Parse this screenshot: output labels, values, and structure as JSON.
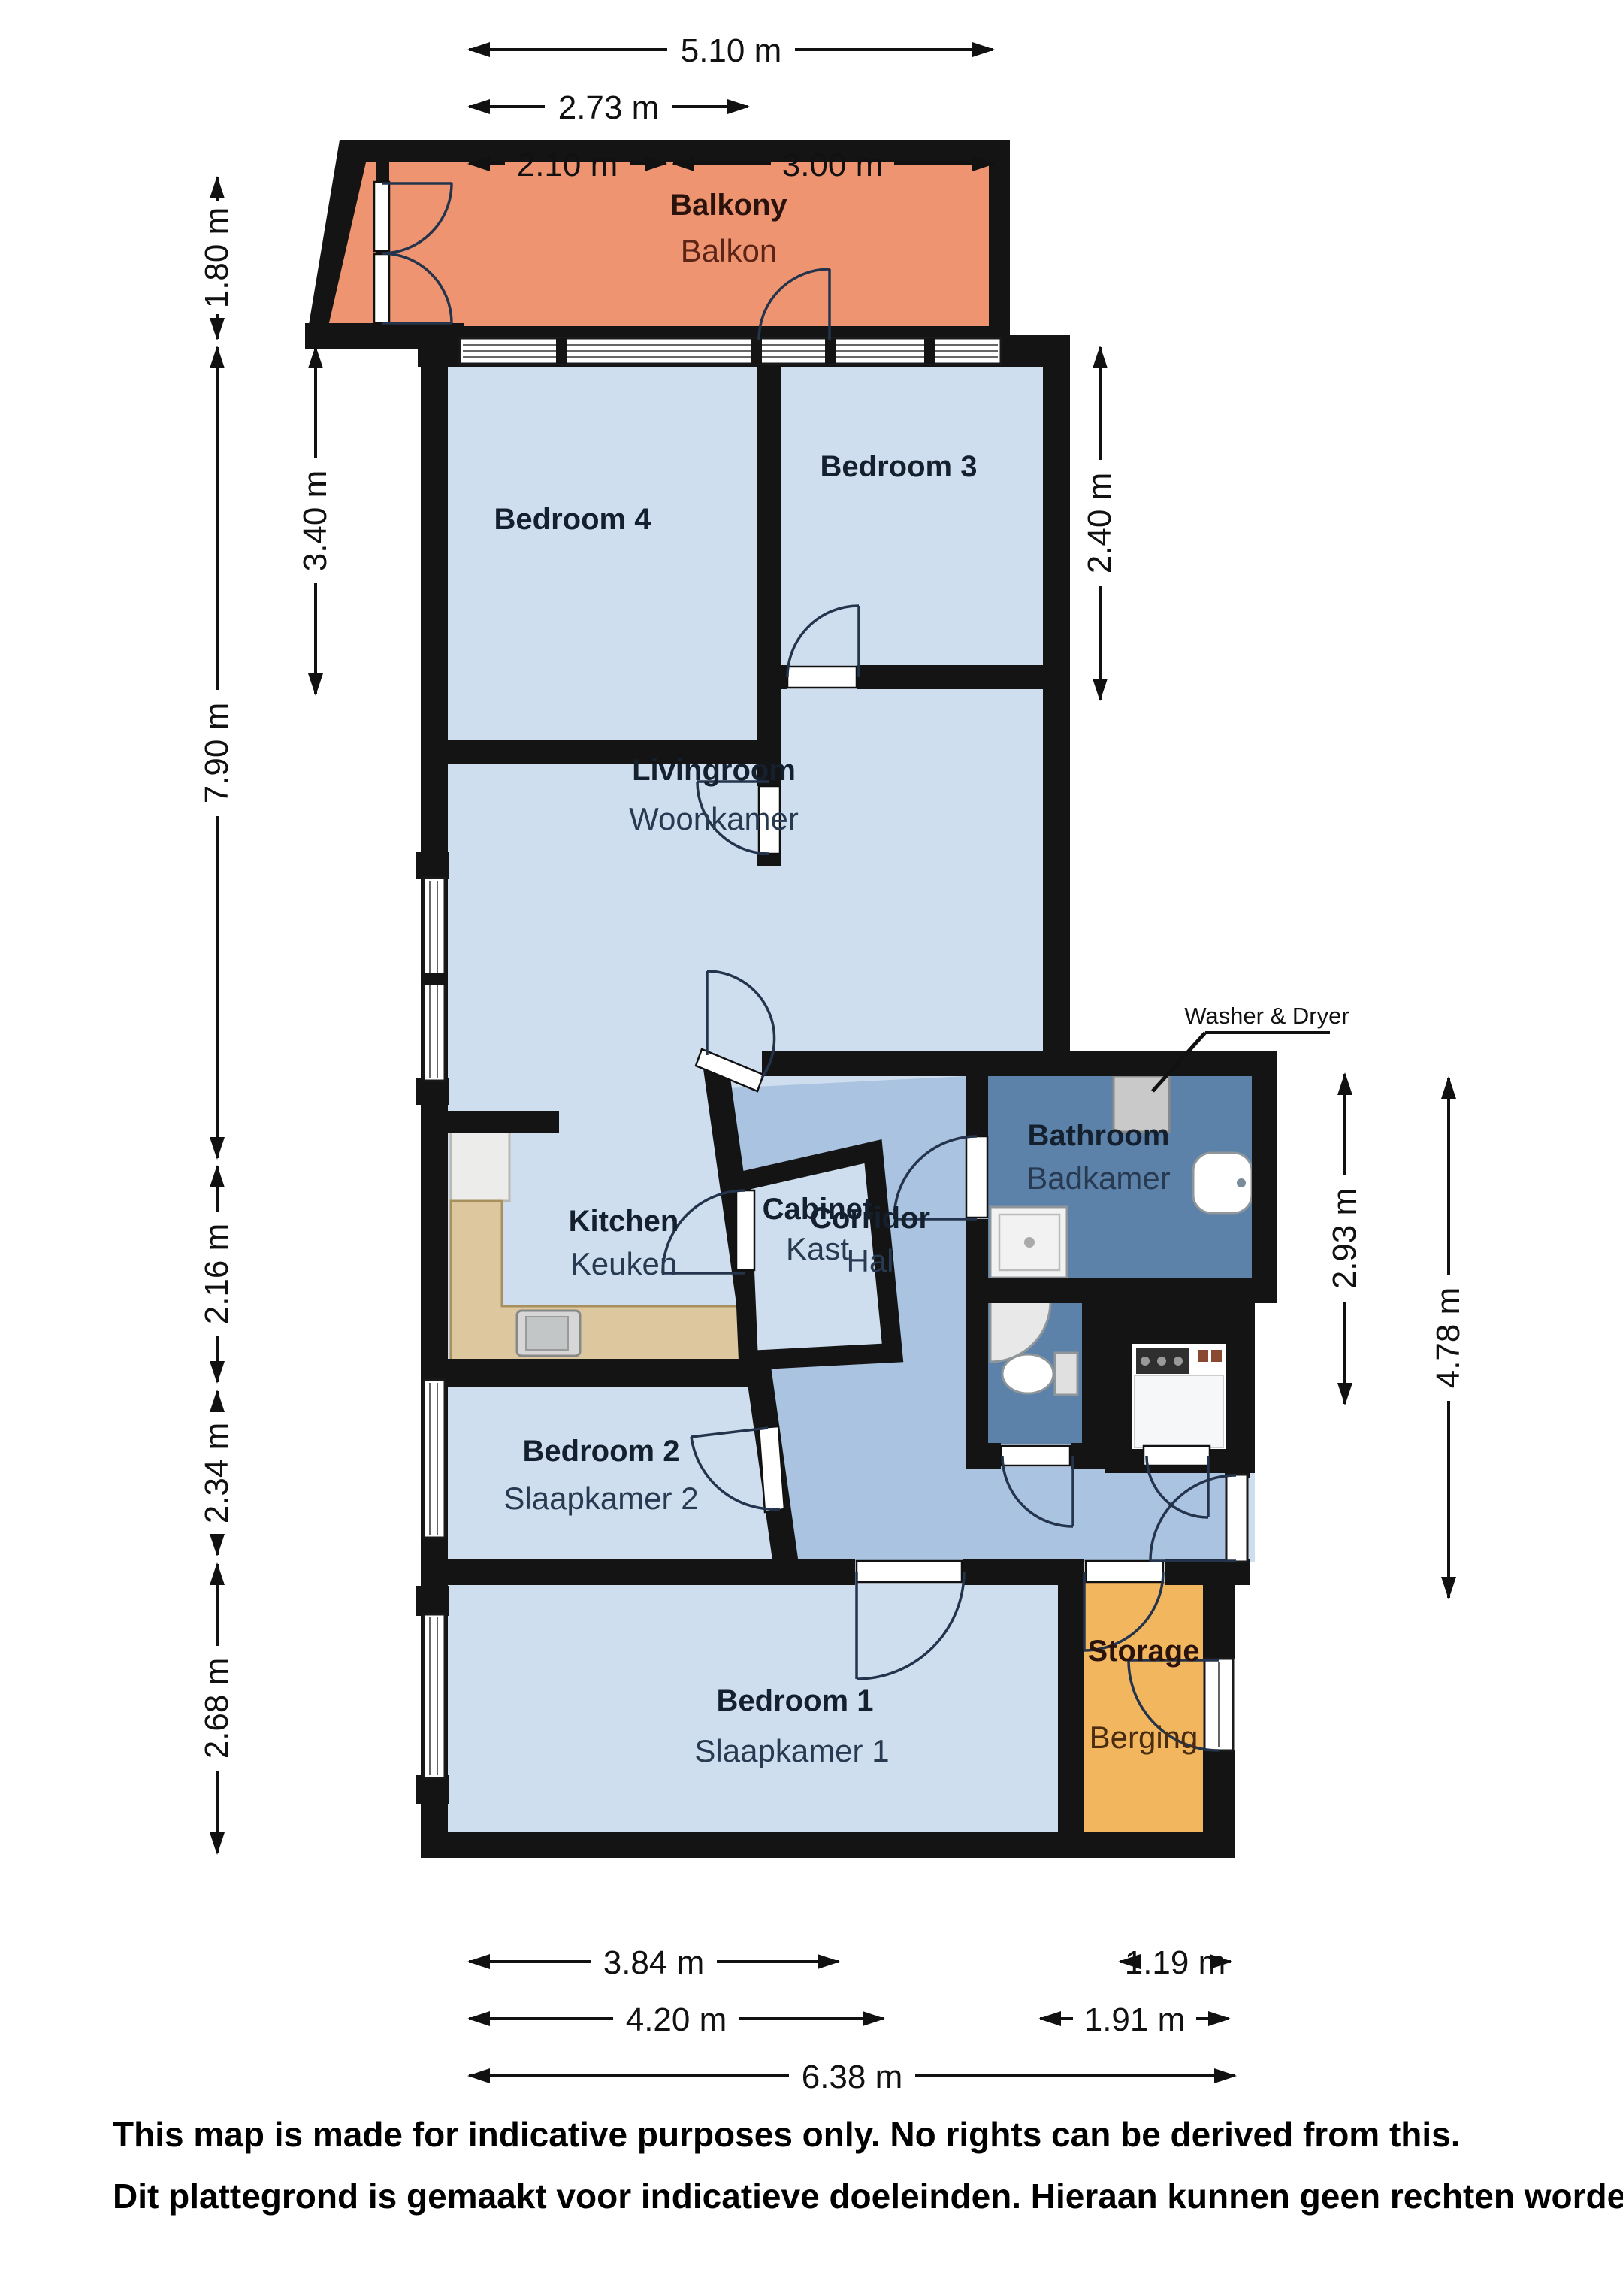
{
  "rooms": [
    {
      "en": "Balkony",
      "du": "Balkon"
    },
    {
      "en": "Bedroom 3",
      "du": ""
    },
    {
      "en": "Bedroom 4",
      "du": ""
    },
    {
      "en": "Livingroom",
      "du": "Woonkamer"
    },
    {
      "en": "Kitchen",
      "du": "Keuken"
    },
    {
      "en": "Cabinet",
      "du": "Kast"
    },
    {
      "en": "Corridor",
      "du": "Hal"
    },
    {
      "en": "Bathroom",
      "du": "Badkamer"
    },
    {
      "en": "Bedroom 2",
      "du": "Slaapkamer 2"
    },
    {
      "en": "Bedroom 1",
      "du": "Slaapkamer 1"
    },
    {
      "en": "Storage",
      "du": "Berging"
    }
  ],
  "annotations": {
    "washer_dryer": "Washer & Dryer"
  },
  "dimensions": {
    "top": [
      "5.10 m",
      "2.73 m",
      "2.10 m",
      "3.00 m"
    ],
    "left": [
      "1.80 m",
      "3.40 m",
      "7.90 m",
      "2.16 m",
      "2.34 m",
      "2.68 m"
    ],
    "right": [
      "2.40 m",
      "2.93 m",
      "4.78 m"
    ],
    "bottom": [
      "3.84 m",
      "1.19 m",
      "4.20 m",
      "1.91 m",
      "6.38 m"
    ]
  },
  "disclaimer": {
    "en": "This map is made for indicative purposes only. No rights can be derived from this.",
    "du": "Dit plattegrond is gemaakt voor indicatieve doeleinden. Hieraan kunnen geen rechten worden."
  },
  "colors": {
    "wall": "#141414",
    "room_light_blue": "#cfdeee",
    "corridor_blue": "#a9c3e1",
    "bathroom_blue": "#5d82aa",
    "balcony_orange": "#ee9470",
    "storage_amber": "#f2b75e",
    "counter_tan": "#dcc79e"
  }
}
